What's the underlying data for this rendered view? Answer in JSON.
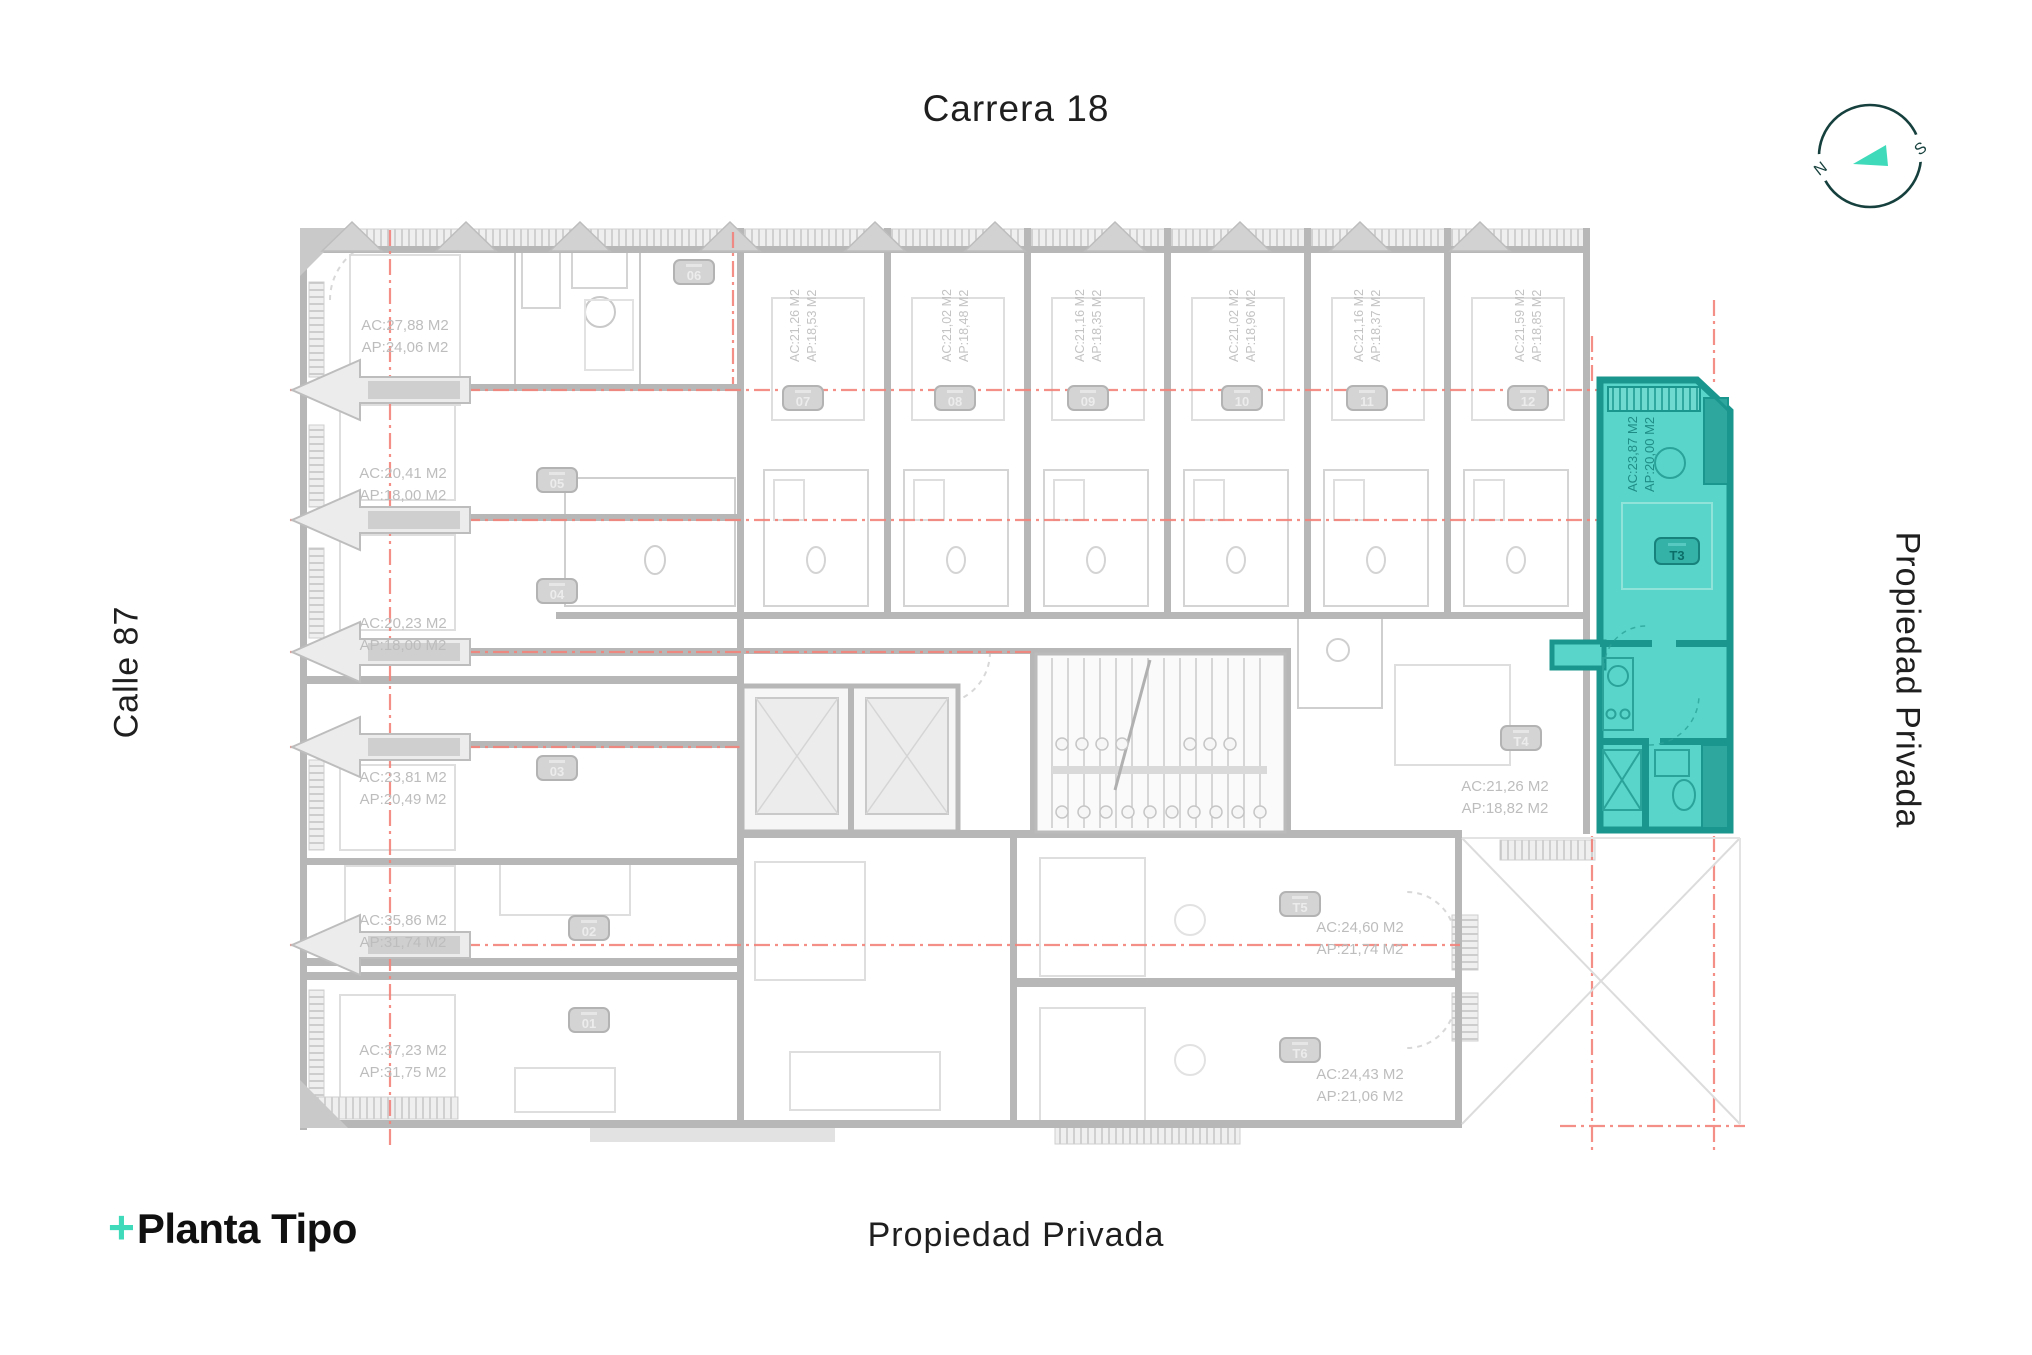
{
  "colors": {
    "accent_teal": "#3EDAB9",
    "highlight_fill": "#5AD5C9",
    "highlight_wall": "#1B968E",
    "grid_red": "#F2837B",
    "plan_gray": "#B7B7B7",
    "label_gray": "#BDBDBD",
    "ink": "#1E1E1E",
    "compass_ring": "#16403D"
  },
  "header": {
    "top_street": "Carrera 18"
  },
  "margins": {
    "left_street": "Calle 87",
    "right_label": "Propiedad Privada",
    "bottom_label": "Propiedad Privada"
  },
  "brand": {
    "plus": "+",
    "name": "Planta Tipo"
  },
  "compass": {
    "north": "N",
    "south": "S"
  },
  "highlight_unit": {
    "id": "T3",
    "ac": "AC:23,87 M2",
    "ap": "AP:20,00 M2"
  },
  "units": [
    {
      "id": "01",
      "ac": "AC:37,23 M2",
      "ap": "AP:31,75 M2"
    },
    {
      "id": "02",
      "ac": "AC:35,86 M2",
      "ap": "AP:31,74 M2"
    },
    {
      "id": "03",
      "ac": "AC:23,81 M2",
      "ap": "AP:20,49 M2"
    },
    {
      "id": "04",
      "ac": "AC:20,23 M2",
      "ap": "AP:18,00 M2"
    },
    {
      "id": "05",
      "ac": "AC:20,41 M2",
      "ap": "AP:18,00 M2"
    },
    {
      "id": "06",
      "ac": "AC:27,88 M2",
      "ap": "AP:24,06 M2"
    },
    {
      "id": "07",
      "ac": "AC:21,26 M2",
      "ap": "AP:18,53 M2"
    },
    {
      "id": "08",
      "ac": "AC:21,02 M2",
      "ap": "AP:18,48 M2"
    },
    {
      "id": "09",
      "ac": "AC:21,16 M2",
      "ap": "AP:18,35 M2"
    },
    {
      "id": "10",
      "ac": "AC:21,02 M2",
      "ap": "AP:18,96 M2"
    },
    {
      "id": "11",
      "ac": "AC:21,16 M2",
      "ap": "AP:18,37 M2"
    },
    {
      "id": "12",
      "ac": "AC:21,59 M2",
      "ap": "AP:18,85 M2"
    },
    {
      "id": "T4",
      "ac": "AC:21,26 M2",
      "ap": "AP:18,82 M2"
    },
    {
      "id": "T5",
      "ac": "AC:24,60 M2",
      "ap": "AP:21,74 M2"
    },
    {
      "id": "T6",
      "ac": "AC:24,43 M2",
      "ap": "AP:21,06 M2"
    }
  ]
}
